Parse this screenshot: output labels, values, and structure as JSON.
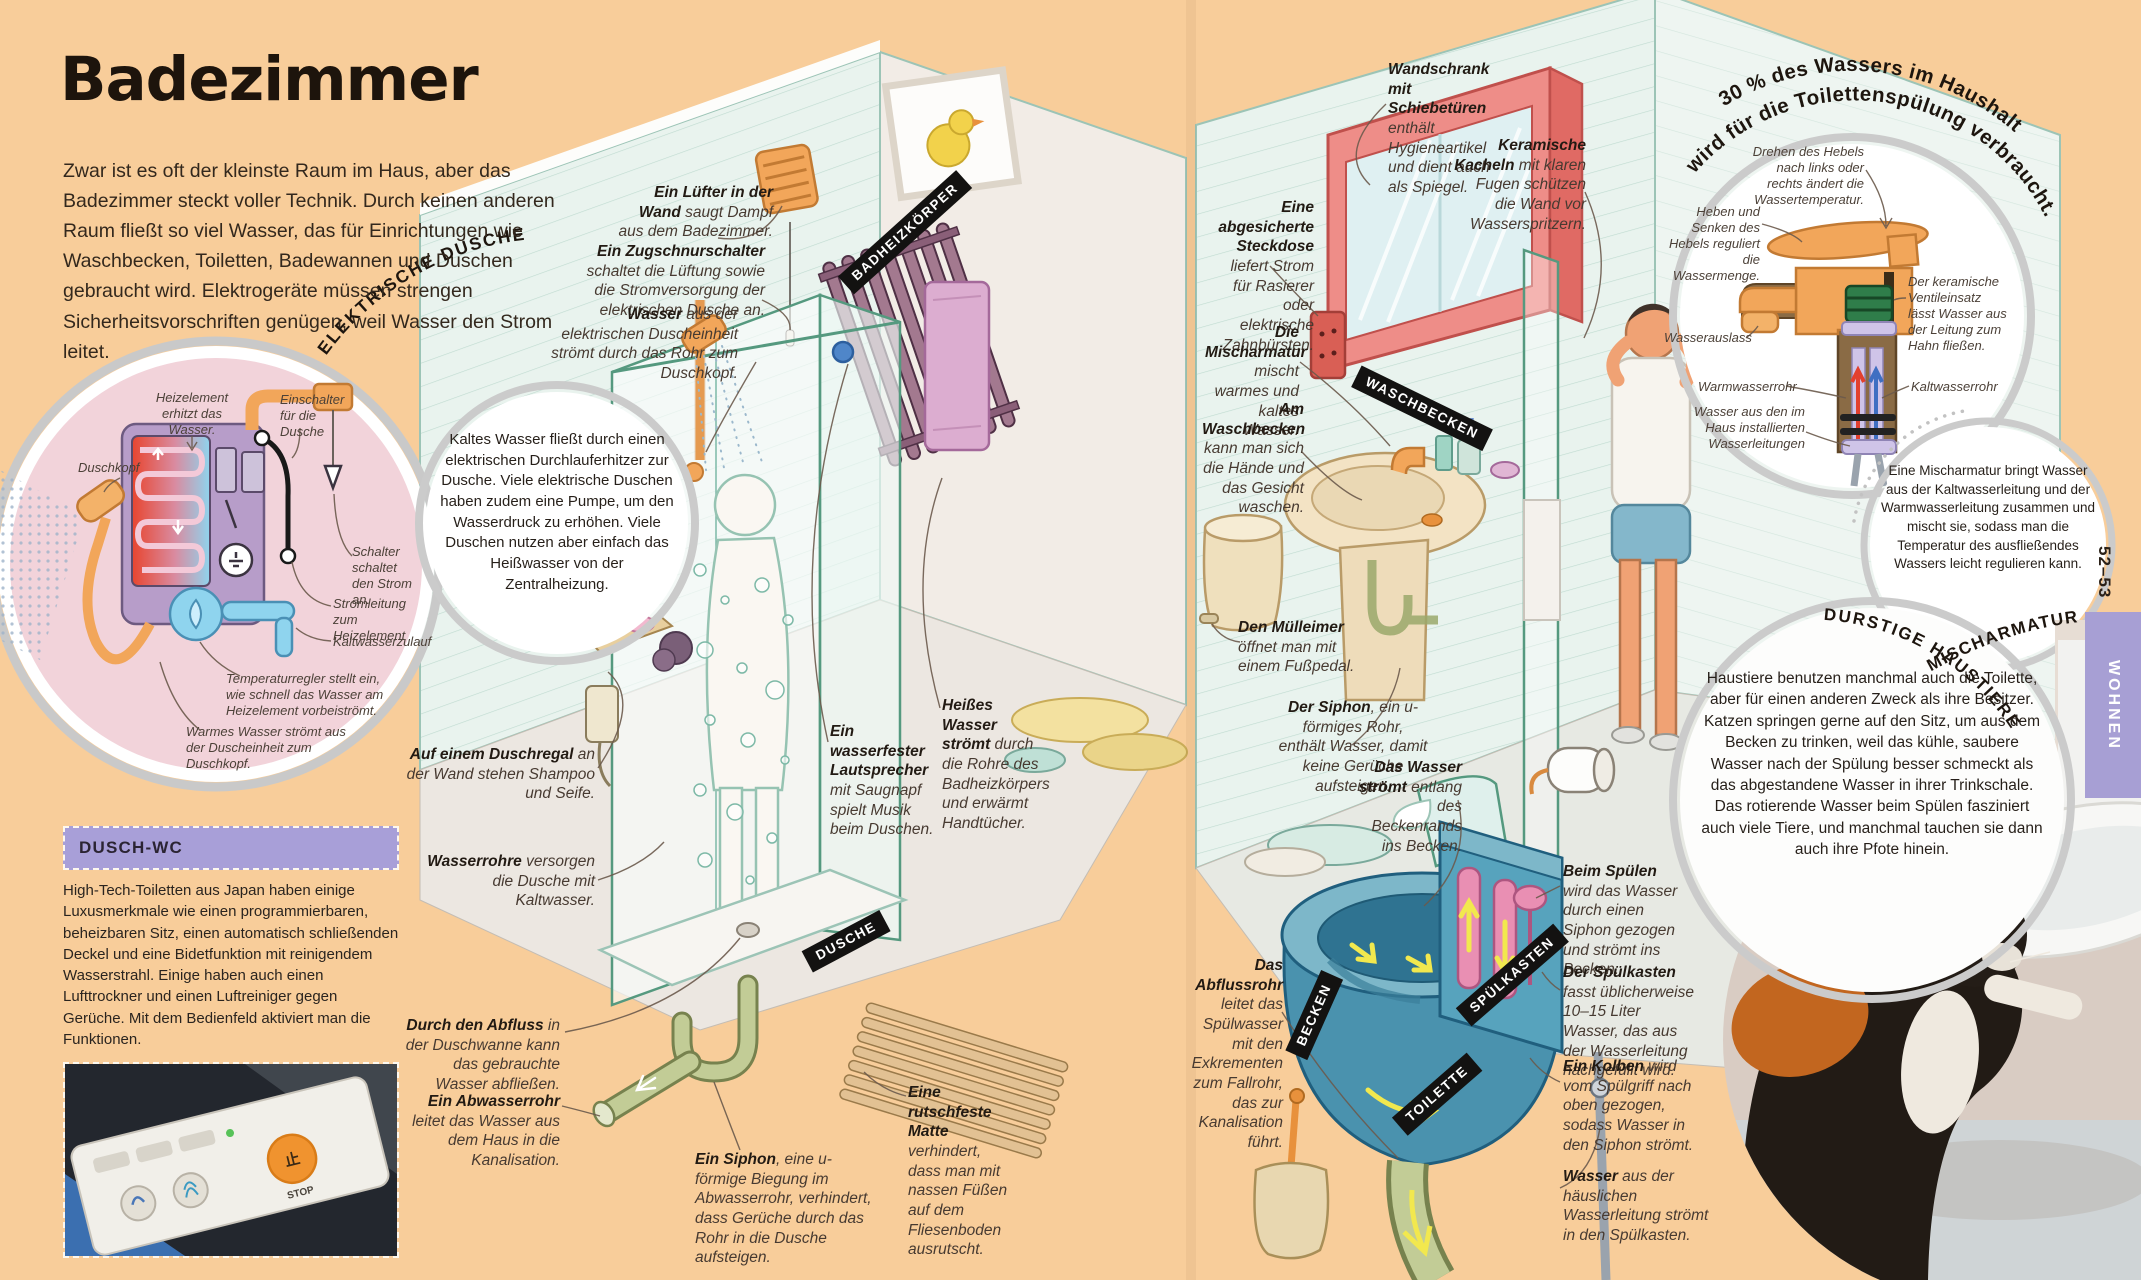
{
  "page": {
    "title": "Badezimmer",
    "intro": "Zwar ist es oft der kleinste Raum im Haus, aber das Badezimmer steckt voller Technik. Durch keinen anderen Raum fließt so viel Wasser, das für Einrichtungen wie Waschbecken, Toiletten, Badewannen und Duschen gebraucht wird. Elektrogeräte müssen strengen Sicherheitsvorschriften genügen, weil Wasser den Strom leitet.",
    "page_number": "52–53",
    "section_tab": "WOHNEN"
  },
  "arc_labels": {
    "fact_line1": "30 % des Wassers im Haushalt",
    "fact_line2": "wird für die Toilettenspülung verbraucht.",
    "electric": "ELEKTRISCHE DUSCHE",
    "mixer": "MISCHARMATUR",
    "pets": "DURSTIGE HAUSTIERE"
  },
  "tags": [
    "BADHEIZKÖRPER",
    "DUSCHE",
    "WASCHBECKEN",
    "BECKEN",
    "SPÜLKASTEN",
    "TOILETTE"
  ],
  "bubbles": {
    "electric": "Kaltes Wasser fließt durch einen elektrischen Durchlauferhitzer zur Dusche. Viele elektrische Duschen haben zudem eine Pumpe, um den Wasserdruck zu erhöhen. Viele Duschen nutzen aber einfach das Heißwasser von der Zentralheizung.",
    "mixer": "Eine Mischarmatur bringt Wasser aus der Kaltwasserleitung und der Warmwasserleitung zusammen und mischt sie, sodass man die Temperatur des ausfließendes Wassers leicht regulieren kann.",
    "pets": "Haustiere benutzen manchmal auch die Toilette, aber für einen anderen Zweck als ihre Besitzer. Katzen springen gerne auf den Sitz, um aus dem Becken zu trinken, weil das kühle, saubere Wasser nach der Spülung besser schmeckt als das abgestandene Wasser in ihrer Trinkschale. Das rotierende Wasser beim Spülen fasziniert auch viele Tiere, und manchmal tauchen sie dann auch ihre Pfote hinein."
  },
  "room_labels": [
    {
      "b": "Ein Lüfter in der Wand",
      "t": " saugt Dampf aus dem Badezimmer."
    },
    {
      "b": "Ein Zugschnurschalter",
      "t": " schaltet die Lüftung sowie die Stromversorgung der elektrischen Dusche an."
    },
    {
      "b": "Wasser",
      "t": " aus der elektrischen Duscheinheit strömt durch das Rohr zum Duschkopf."
    },
    {
      "b": "Auf einem Duschregal",
      "t": " an der Wand stehen Shampoo und Seife."
    },
    {
      "b": "Wasserrohre",
      "t": " versorgen die Dusche mit Kaltwasser."
    },
    {
      "b": "Durch den Abfluss",
      "t": " in der Duschwanne kann das gebrauchte Wasser abfließen."
    },
    {
      "b": "Ein Abwasserrohr",
      "t": " leitet das Wasser aus dem Haus in die Kanalisation."
    },
    {
      "b": "Ein Siphon",
      "t": ", eine u-förmige Biegung im Abwasserrohr, verhindert, dass Gerüche durch das Rohr in die Dusche aufsteigen."
    },
    {
      "b": "Ein wasserfester Lautsprecher",
      "t": " mit Saugnapf spielt Musik beim Duschen."
    },
    {
      "b": "Heißes Wasser strömt",
      "t": " durch die Rohre des Badheizkörpers und erwärmt Handtücher."
    },
    {
      "b": "Eine rutschfeste Matte",
      "t": " verhindert, dass man mit nassen Füßen auf dem Fliesenboden ausrutscht."
    },
    {
      "b": "Wandschrank mit Schiebetüren",
      "t": " enthält Hygieneartikel und dient auch als Spiegel."
    },
    {
      "b": "Keramische Kacheln",
      "t": " mit klaren Fugen schützen die Wand vor Wasserspritzern."
    },
    {
      "b": "Eine abgesicherte Steckdose",
      "t": " liefert Strom für Rasierer oder elektrische Zahnbürsten."
    },
    {
      "b": "Die Mischarmatur",
      "t": " mischt warmes und kaltes Wasser."
    },
    {
      "b": "Am Waschbecken",
      "t": " kann man sich die Hände und das Gesicht waschen."
    },
    {
      "b": "Den Mülleimer",
      "t": " öffnet man mit einem Fußpedal."
    },
    {
      "b": "Der Siphon",
      "t": ", ein u-förmiges Rohr, enthält Wasser, damit keine Gerüche aufsteigen."
    },
    {
      "b": "Das Wasser strömt",
      "t": " entlang des Beckenrands ins Becken."
    },
    {
      "b": "Das Abflussrohr",
      "t": " leitet das Spülwasser mit den Exkrementen zum Fallrohr, das zur Kanalisation führt."
    },
    {
      "b": "Beim Spülen",
      "t": " wird das Wasser durch einen Siphon gezogen und strömt ins Becken."
    },
    {
      "b": "Der Spülkasten",
      "t": " fasst üblicherweise 10–15 Liter Wasser, das aus der Wasserleitung nachgefüllt wird."
    },
    {
      "b": "Ein Kolben",
      "t": " wird vom Spülgriff nach oben gezogen, sodass Wasser in den Siphon strömt."
    },
    {
      "b": "Wasser",
      "t": " aus der häuslichen Wasserleitung strömt in den Spülkasten."
    }
  ],
  "electric_shower": {
    "labels": [
      "Duschkopf",
      "Heizelement erhitzt das Wasser.",
      "Einschalter für die Dusche",
      "Schalter schaltet den Strom an.",
      "Stromleitung zum Heizelement",
      "Kaltwasserzulauf",
      "Temperaturregler stellt ein, wie schnell das Wasser am Heizelement vorbeiströmt.",
      "Warmes Wasser strömt aus der Duscheinheit zum Duschkopf."
    ]
  },
  "mixer": {
    "labels": [
      "Drehen des Hebels nach links oder rechts ändert die Wassertemperatur.",
      "Heben und Senken des Hebels reguliert die Wassermenge.",
      "Der keramische Ventileinsatz lässt Wasser aus der Leitung zum Hahn fließen.",
      "Wasserauslass",
      "Warmwasserrohr",
      "Kaltwasserrohr",
      "Wasser aus den im Haus installierten Wasserleitungen"
    ]
  },
  "dusch_wc": {
    "heading": "DUSCH-WC",
    "body": "High-Tech-Toiletten aus Japan haben einige Luxusmerkmale wie einen programmierbaren, beheizbaren Sitz, einen automatisch schließenden Deckel und eine Bidetfunktion mit reinigendem Wasserstrahl. Einige haben auch einen Lufttrockner und einen Luftreiniger gegen Gerüche. Mit dem Bedienfeld aktiviert man die Funktionen.",
    "panel_labels": [
      "止",
      "STOP"
    ]
  },
  "colors": {
    "page_bg": "#f8cd9a",
    "wall_mint": "#e9f3ee",
    "tile_line": "#c0dbd1",
    "pink_circle": "#f2d3da",
    "ring_gray": "#cbcbcb",
    "tag_bg": "#131211",
    "accent_orange": "#f2a65a",
    "toilet_blue": "#4a92ae",
    "cistern_pink": "#e98fb3",
    "cabinet_red": "#ee8d88",
    "purple_header": "#a89fd8",
    "tab_purple": "#a79fd4"
  }
}
